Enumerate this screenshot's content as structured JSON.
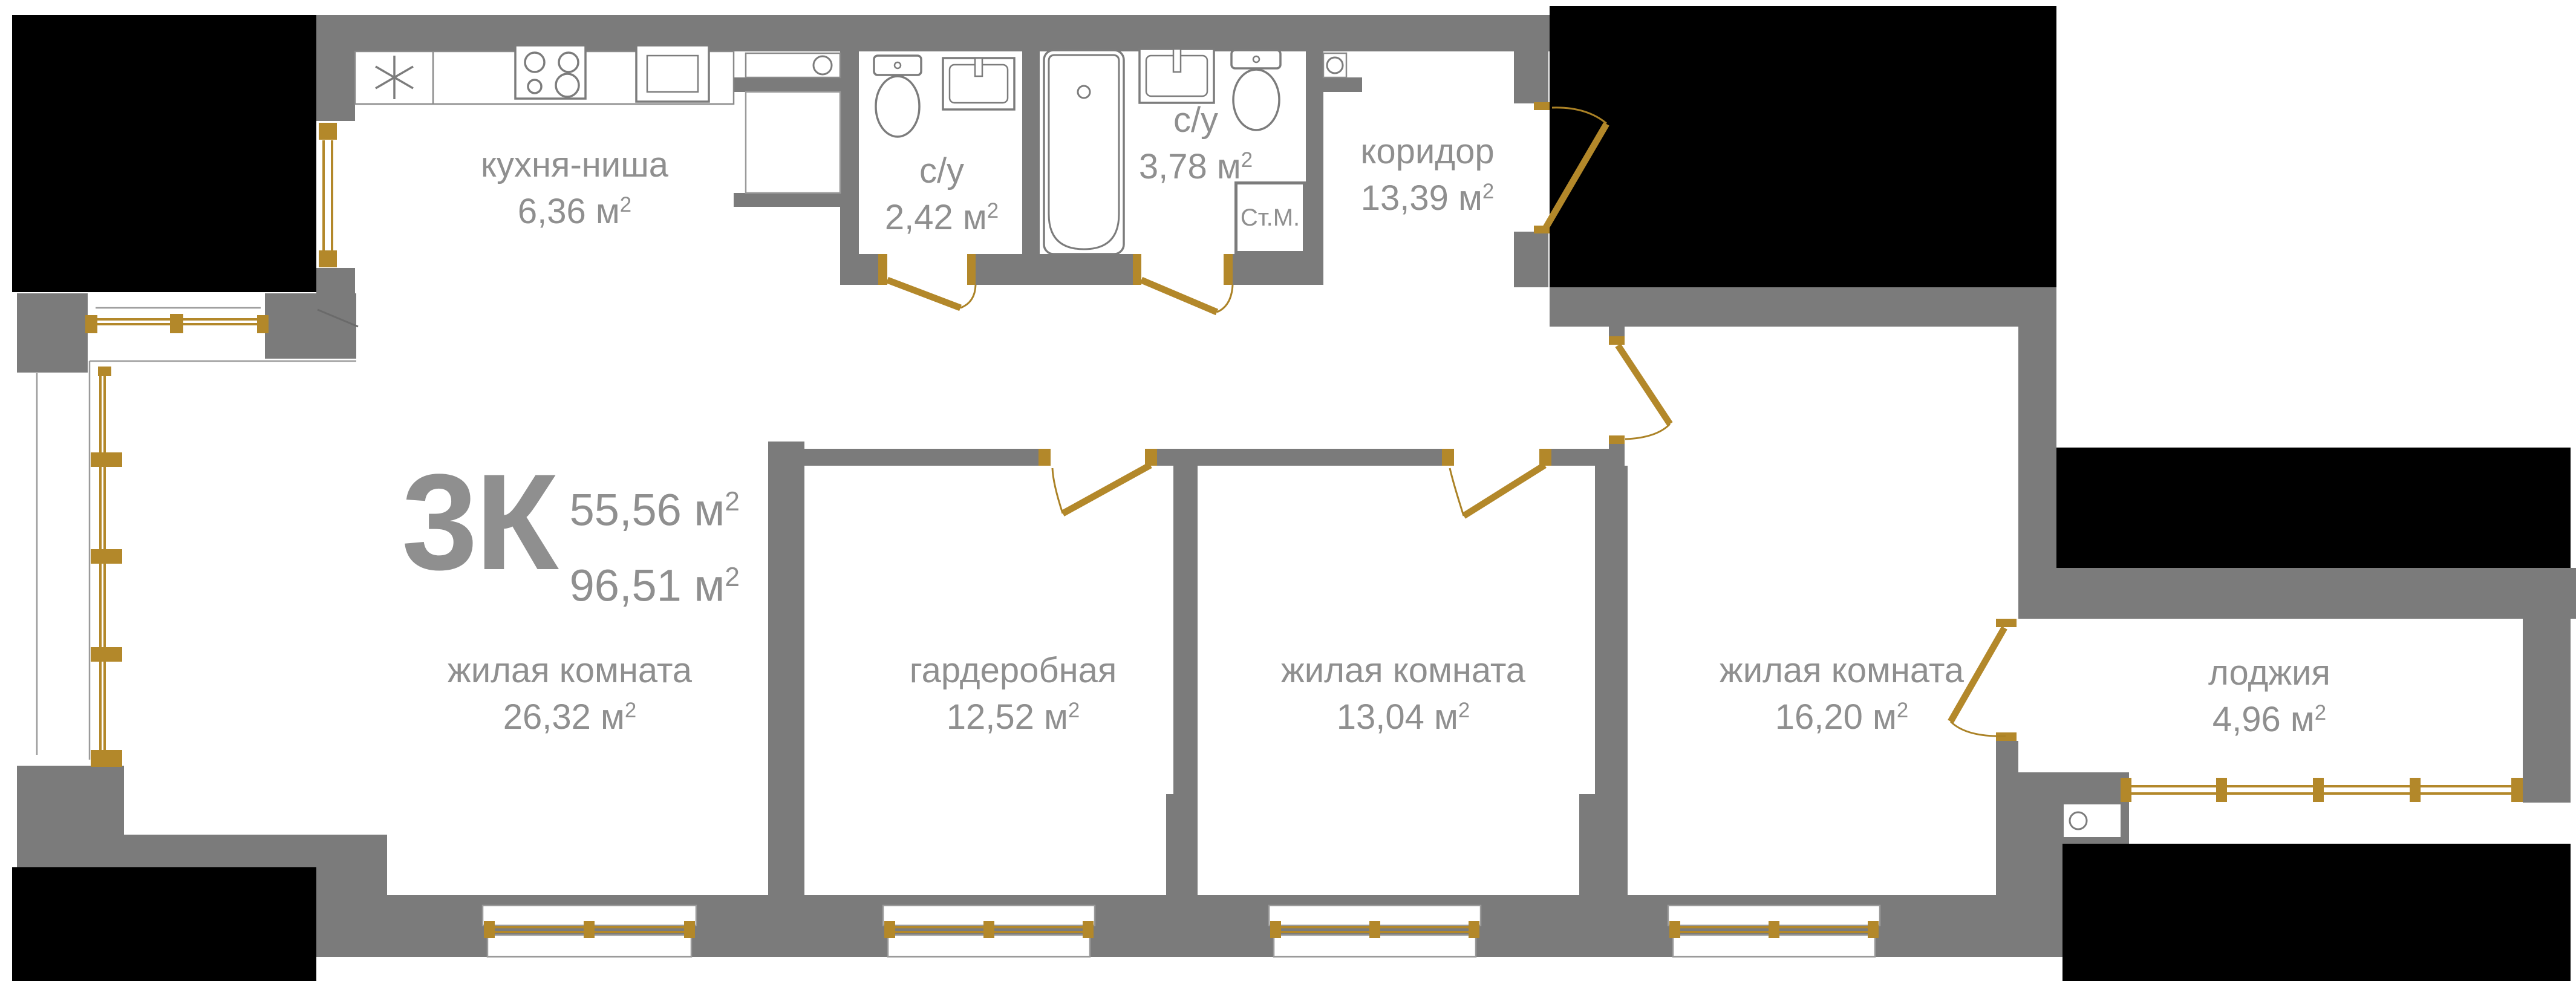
{
  "colors": {
    "wall": "#7b7b7b",
    "outside_mask": "#000000",
    "joinery_gold": "#b3882a",
    "label_text": "#8f8f8f",
    "fixture_stroke": "#7c7c7c"
  },
  "plan_summary": {
    "type_label": "3К",
    "living_area": "55,56 м",
    "total_area": "96,51 м",
    "sup": "2"
  },
  "rooms": {
    "kitchen": {
      "name": "кухня-ниша",
      "area": "6,36 м",
      "sup": "2"
    },
    "bath_small": {
      "name": "с/у",
      "area": "2,42 м",
      "sup": "2"
    },
    "bath_big": {
      "name": "с/у",
      "area": "3,78 м",
      "sup": "2"
    },
    "corridor": {
      "name": "коридор",
      "area": "13,39 м",
      "sup": "2"
    },
    "living": {
      "name": "жилая комната",
      "area": "26,32 м",
      "sup": "2"
    },
    "wardrobe": {
      "name": "гардеробная",
      "area": "12,52 м",
      "sup": "2"
    },
    "bedroom2": {
      "name": "жилая комната",
      "area": "13,04 м",
      "sup": "2"
    },
    "bedroom3": {
      "name": "жилая комната",
      "area": "16,20 м",
      "sup": "2"
    },
    "loggia": {
      "name": "лоджия",
      "area": "4,96 м",
      "sup": "2"
    }
  },
  "appliances": {
    "washing_machine_label": "Ст.М."
  }
}
